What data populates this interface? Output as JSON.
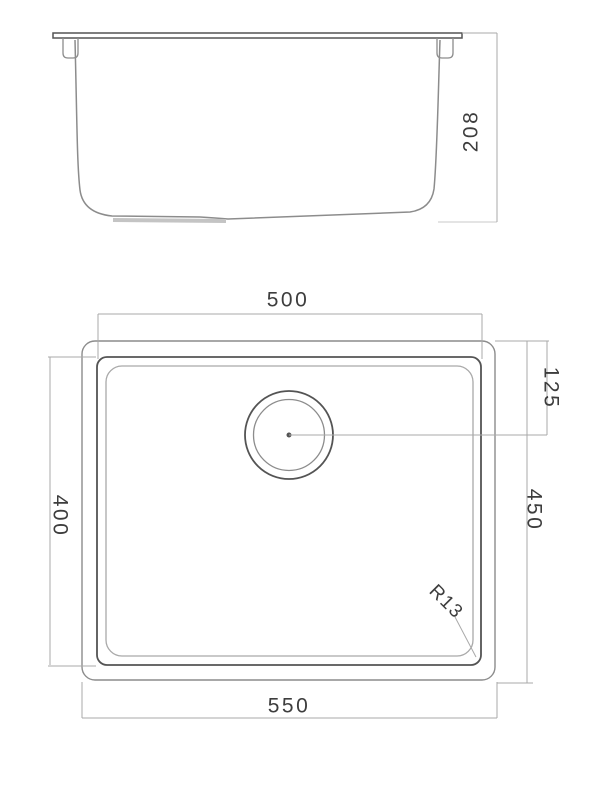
{
  "drawing_title": "undermount-sink-dimension-drawing",
  "labels": {
    "side_height": "208",
    "bowl_width": "500",
    "bowl_depth": "400",
    "overall_width": "550",
    "overall_depth": "450",
    "drain_center_offset": "125",
    "corner_radius": "R13"
  },
  "colors": {
    "background": "#ffffff",
    "line_dark": "#545454",
    "line_mid": "#8c8c8c",
    "line_light": "#a9a9a9",
    "drain_boss": "#c4c4c4",
    "text": "#3d3d3d"
  }
}
